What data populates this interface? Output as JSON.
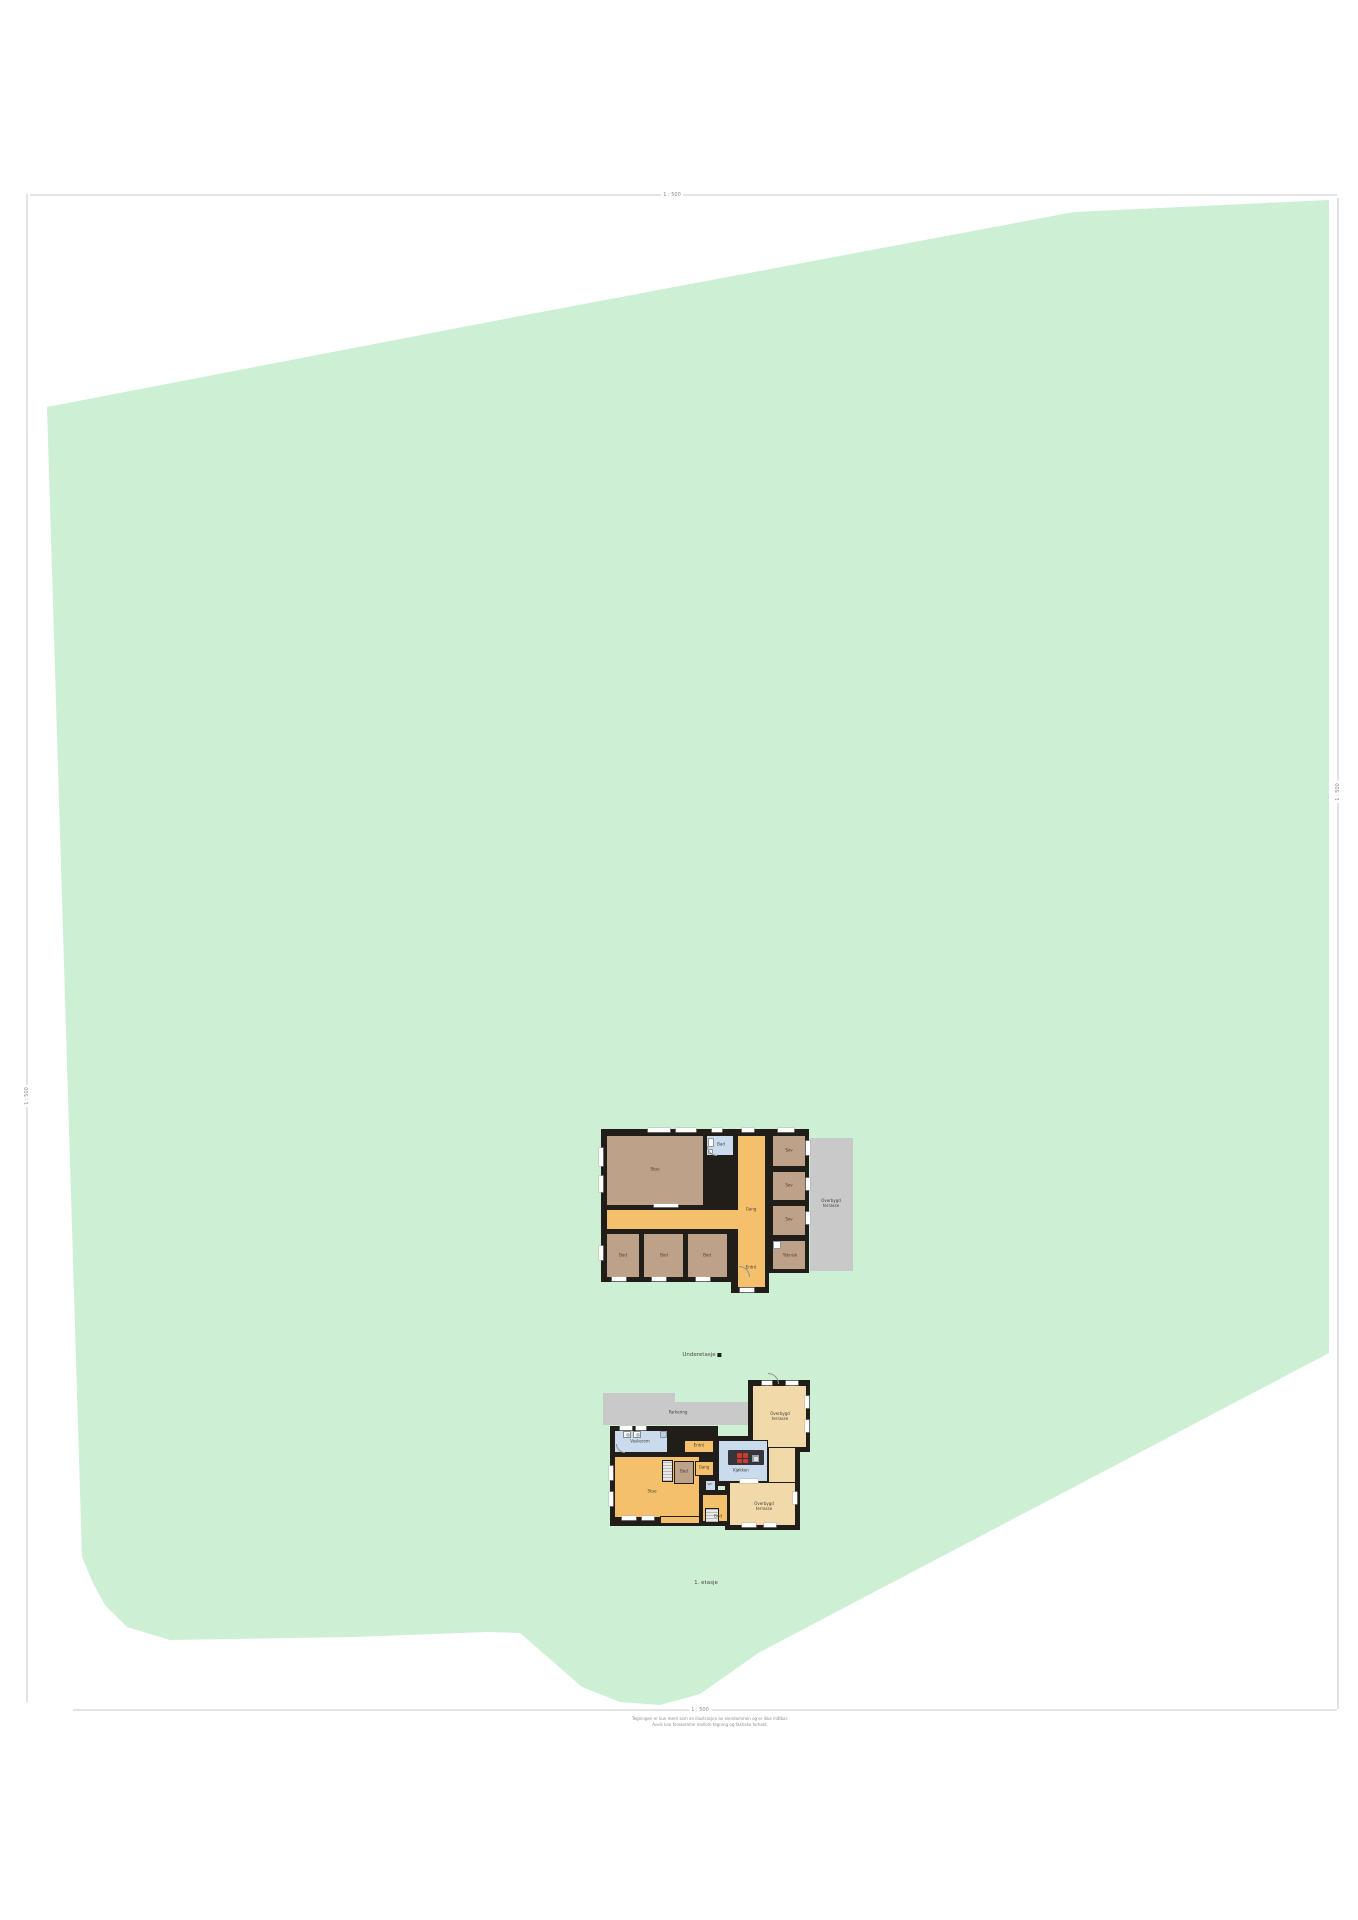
{
  "page": {
    "frame": {
      "scale_top": "1 : 500",
      "scale_bottom": "1 : 500",
      "scale_left": "1 : 500",
      "scale_right": "1 : 500"
    },
    "footer": {
      "line1": "Tegningen er kun ment som en illustrasjon av eiendommen og er ikke målbar.",
      "line2": "Avvik kan forekomme mellom tegning og faktiske forhold."
    },
    "colors": {
      "plot_green": "#cdf0d4",
      "paving_gray": "#c9c9c9",
      "wall_black": "#211e19",
      "room_tan": "#bda189",
      "room_orange": "#f5c06c",
      "room_beige": "#f2d9a9",
      "room_blue": "#c9dbec"
    }
  },
  "upper_plan": {
    "caption": "Underetasje",
    "rooms": {
      "stue": "Stue",
      "bad": "Bad",
      "gang": "Gang",
      "sov1": "Sov",
      "sov2": "Sov",
      "sov3": "Sov",
      "teknisk": "Teknisk",
      "bod1": "Bod",
      "bod2": "Bod",
      "bod3": "Bod",
      "entre": "Entré",
      "terrasse_line1": "Overbygd",
      "terrasse_line2": "terrasse"
    }
  },
  "lower_plan": {
    "caption": "1. etasje",
    "rooms": {
      "parkering": "Parkering",
      "vaskerom": "Vaskerom",
      "stue": "Stue",
      "kjokken": "Kjøkken",
      "bad": "Bad",
      "gang": "Gang",
      "entre": "Entré",
      "wc": "WC",
      "bod": "Bod",
      "terrasse_top_line1": "Overbygd",
      "terrasse_top_line2": "terrasse",
      "terrasse_bottom_line1": "Overbygd",
      "terrasse_bottom_line2": "terrasse"
    }
  }
}
